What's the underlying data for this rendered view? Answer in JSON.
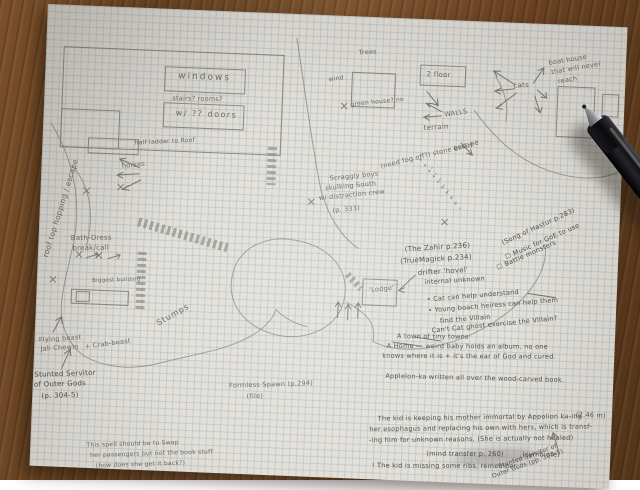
{
  "scene": {
    "type": "photo of hand-drawn pencil map on graph paper",
    "objects": {
      "pen": "black ballpoint pen",
      "surface": "wood desk"
    },
    "colors": {
      "desk": "#6f4726",
      "paper": "#e2e0d9",
      "grid": "#9fb0c0",
      "pencil": "#6b6a62",
      "pen_ink_body": "#141416"
    }
  },
  "labels": {
    "roof_hopping": "roof top hopping / escape",
    "windows": "windows",
    "stairs_rooms": "stairs? rooms?",
    "doors": "w/ ?? doors",
    "half_ladder": "half ladder to Roof",
    "horses": "horses",
    "trees": "Trees",
    "wind": "wind",
    "two_floor": "2 floor",
    "greenhouse": "green house? no",
    "walls": "WALLS",
    "terrain": "terrain",
    "escape": "escape",
    "need_fog": "(need fog off?) stone bed +",
    "scraggly1": "Scraggly boys",
    "scraggly2": "skulking South",
    "scraggly3": "w/ distraction crew",
    "scraggly4": "(p. 333)",
    "cats": "cats",
    "boat1": "boat house",
    "boat2": "that will never",
    "boat3": "reach",
    "bath1": "Bath-Dress",
    "bath2": "break/call",
    "biggest": "Biggest building",
    "stumps": "Stumps",
    "zahir": "(The Zahir p.236)",
    "truemagick": "(TrueMagick p.234)",
    "drifter1": "drifter 'hovel'",
    "drifter2": "internal unknown",
    "lodge": "'Lodge'",
    "hastur": "(Song of Hastur p.283)",
    "music": "☐ Music for GoE to use",
    "battle": "☐ Battle monsters",
    "cat_help": "• Cat can help understand",
    "heiress1": "• Young boach heiress can help them",
    "heiress2": "find the Villain",
    "exorcise": "Can't Cat ghost exorcise the Villain?",
    "town1": "A town of tiny towns",
    "town2": "A Home — weird baby holds an album, no one",
    "town3": "knows where it is + it's the ear of God and cured.",
    "applelon": "Applelon-ka written all over the wood-carved book.",
    "formless1": "Formless Spawn (p.294)",
    "formless2": "(file)",
    "measure": "(2.46 m)",
    "kid1": "The kid is keeping his mother immortal by Appolion ka-ing",
    "kid2": "her esophagus and replacing his own with hers, which is transf-",
    "kid3": "-ing him for unknown reasons. (She is actually not healed)",
    "mind_transfer": "(mind transfer p. 260)",
    "symbiote": "(symbiote)",
    "ribs": "! The kid is missing some ribs, remember.",
    "stunted_br1": "Stunted Servitor of",
    "stunted_br2": "Outer Gods (pp. 304-5)",
    "flying1": "Flying beast",
    "flying2": "Jali Chewin",
    "crab": "+ Crab-beast",
    "stunted_l1": "Stunted Servitor",
    "stunted_l2": "of Outer Gods",
    "stunted_l3": "(p. 304-5)",
    "spell1": "This spell should be to Swap",
    "spell2": "her passengers but not the book stuff",
    "spell3": "(how does she get it back?)"
  }
}
